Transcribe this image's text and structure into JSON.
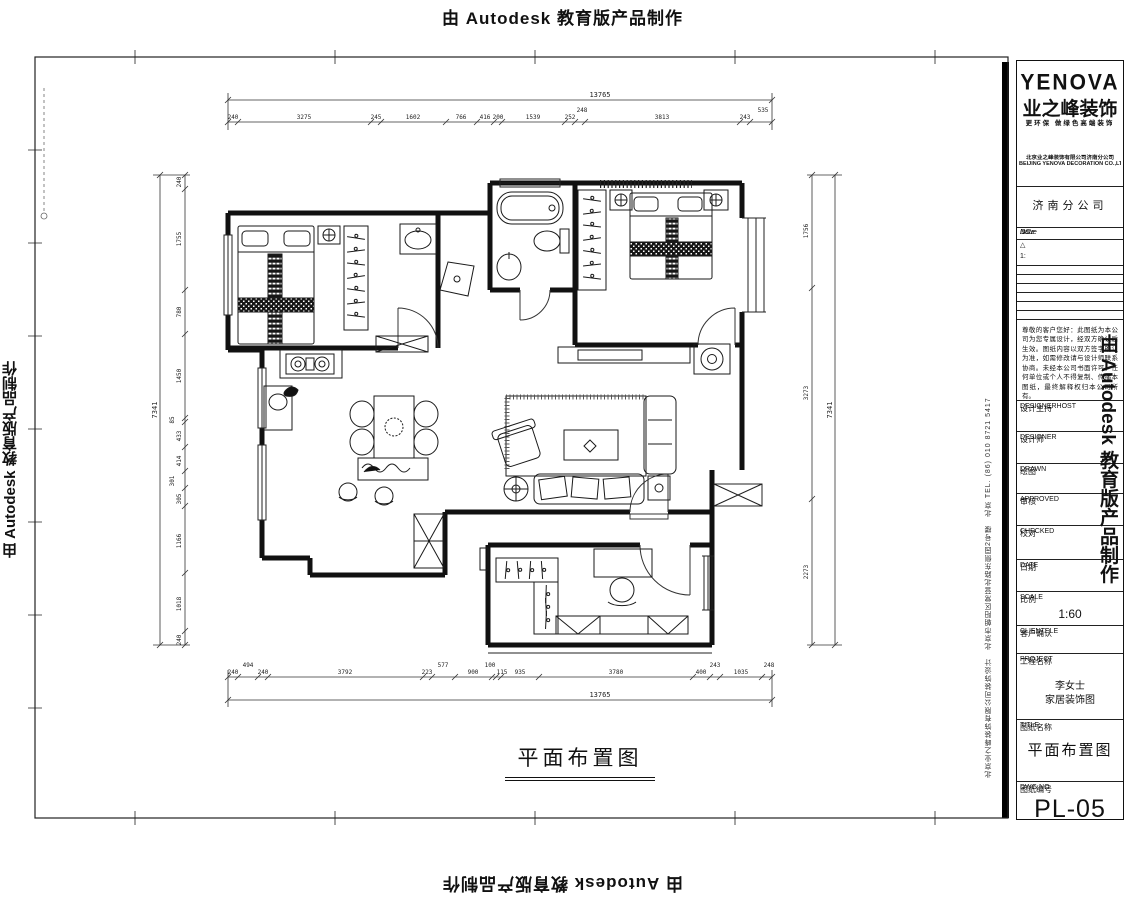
{
  "watermark": {
    "top": "由 Autodesk 教育版产品制作",
    "bottom": "由 Autodesk 教育版产品制作",
    "left": "由 Autodesk 教育版产品制作",
    "right": "由 Autodesk 教育版产品制作"
  },
  "caption": "平面布置图",
  "side_text": {
    "column": "北京业之峰装饰有限公司装饰设计　北京市朝阳区常营北路东侧园2号楼　北京 TEL. (86) 010 8721 5417"
  },
  "dims": {
    "top_overall": "13765",
    "bottom_overall": "13765",
    "left_overall": "7341",
    "right_overall": "7341",
    "top": [
      "240",
      "3275",
      "245",
      "1602",
      "766",
      "416",
      "200",
      "1539",
      "252",
      "248",
      "3813",
      "243",
      "535"
    ],
    "bottom": [
      "240",
      "494",
      "240",
      "3792",
      "223",
      "577",
      "900",
      "100",
      "115",
      "935",
      "3780",
      "400",
      "243",
      "1035",
      "248"
    ],
    "left": [
      "240",
      "1755",
      "780",
      "1450",
      "85",
      "433",
      "414",
      "301",
      "305",
      "1166",
      "1018",
      "240"
    ],
    "right": [
      "1756",
      "3273",
      "2273"
    ]
  },
  "title_block": {
    "brand": "YENOVA",
    "brand_cn": "业之峰装饰",
    "slogan": "更环保 做绿色高端装饰",
    "company_line1": "北京业之峰装饰有限公司济南分公司",
    "company_line2": "BEIJING YENOVA DECORATION CO.,LTD.",
    "branch": "济南分公司",
    "rev": {
      "no": "NO.",
      "issue": "Issue",
      "date": "Date",
      "r1": "△",
      "r2": "1:"
    },
    "notice": "尊敬的客户您好：此图纸为本公司为您专属设计，经双方确认后生效。图纸内容以双方签字确认为准，如需修改请与设计师联系协商。未经本公司书面许可，任何单位或个人不得复制、传播本图纸，最终解释权归本公司所有。",
    "fields": [
      {
        "cn": "设计主持",
        "en": "DESIGNERHOST"
      },
      {
        "cn": "设计师",
        "en": "DESIGNER"
      },
      {
        "cn": "绘图",
        "en": "DRAWN"
      },
      {
        "cn": "审核",
        "en": "APPROVED"
      },
      {
        "cn": "校对",
        "en": "CHECKED"
      },
      {
        "cn": "日期",
        "en": "DATE"
      },
      {
        "cn": "比例",
        "en": "SCALE"
      },
      {
        "cn": "客户确认",
        "en": "CLIENTELE"
      }
    ],
    "scale_value": "1:60",
    "project": {
      "cn": "工程名称",
      "en": "PROJECT",
      "line1": "李女士",
      "line2": "家居装饰图"
    },
    "sheet": {
      "cn": "图纸名称",
      "en": "TITLE",
      "value": "平面布置图"
    },
    "dwg": {
      "cn": "图纸编号",
      "en": "DWG.NO",
      "value": "PL-05"
    }
  }
}
